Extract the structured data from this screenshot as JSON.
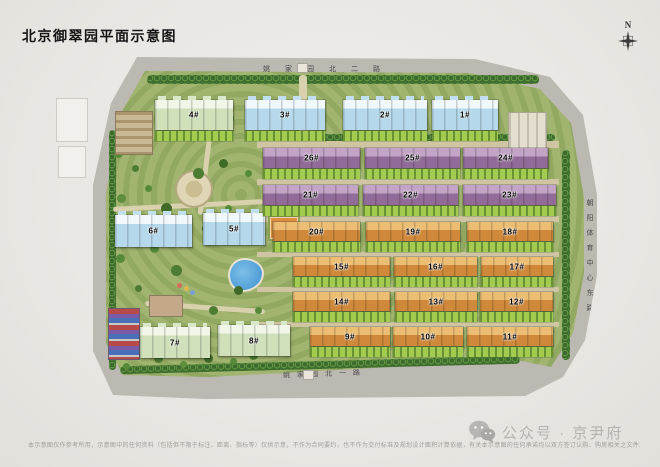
{
  "title": "北京御翠园平面示意图",
  "compass": {
    "north": "N"
  },
  "roads": {
    "top": "姚家园北二路",
    "bottom": "姚家园北一路",
    "right": "朝阳体育中心东路"
  },
  "map": {
    "buildings": [
      {
        "label": "4#",
        "x": 70,
        "y": 45,
        "w": 78,
        "h": 30,
        "palette": "green",
        "garden": true
      },
      {
        "label": "3#",
        "x": 160,
        "y": 45,
        "w": 80,
        "h": 30,
        "palette": "blue",
        "garden": true
      },
      {
        "label": "2#",
        "x": 258,
        "y": 45,
        "w": 84,
        "h": 30,
        "palette": "blue",
        "garden": true
      },
      {
        "label": "1#",
        "x": 347,
        "y": 45,
        "w": 66,
        "h": 30,
        "palette": "blue",
        "garden": true
      },
      {
        "label": "6#",
        "x": 30,
        "y": 160,
        "w": 77,
        "h": 32,
        "palette": "blue",
        "garden": false
      },
      {
        "label": "5#",
        "x": 118,
        "y": 158,
        "w": 62,
        "h": 32,
        "palette": "blue",
        "garden": false
      },
      {
        "label": "7#",
        "x": 55,
        "y": 272,
        "w": 70,
        "h": 31,
        "palette": "green",
        "garden": false
      },
      {
        "label": "8#",
        "x": 133,
        "y": 270,
        "w": 72,
        "h": 31,
        "palette": "green",
        "garden": false
      },
      {
        "label": "26#",
        "x": 178,
        "y": 93,
        "w": 97,
        "h": 20,
        "palette": "purple",
        "garden": true
      },
      {
        "label": "25#",
        "x": 280,
        "y": 93,
        "w": 95,
        "h": 20,
        "palette": "purple",
        "garden": true
      },
      {
        "label": "24#",
        "x": 378,
        "y": 93,
        "w": 85,
        "h": 20,
        "palette": "purple",
        "garden": true
      },
      {
        "label": "21#",
        "x": 178,
        "y": 130,
        "w": 95,
        "h": 20,
        "palette": "purple",
        "garden": true
      },
      {
        "label": "22#",
        "x": 278,
        "y": 130,
        "w": 95,
        "h": 20,
        "palette": "purple",
        "garden": true
      },
      {
        "label": "23#",
        "x": 378,
        "y": 130,
        "w": 93,
        "h": 20,
        "palette": "purple",
        "garden": true
      },
      {
        "label": "20#",
        "x": 188,
        "y": 167,
        "w": 87,
        "h": 19,
        "palette": "orange",
        "garden": true
      },
      {
        "label": "19#",
        "x": 281,
        "y": 167,
        "w": 94,
        "h": 19,
        "palette": "orange",
        "garden": true
      },
      {
        "label": "18#",
        "x": 382,
        "y": 167,
        "w": 86,
        "h": 19,
        "palette": "orange",
        "garden": true
      },
      {
        "label": "15#",
        "x": 208,
        "y": 202,
        "w": 97,
        "h": 19,
        "palette": "orange",
        "garden": true
      },
      {
        "label": "16#",
        "x": 309,
        "y": 202,
        "w": 83,
        "h": 19,
        "palette": "orange",
        "garden": true
      },
      {
        "label": "17#",
        "x": 396,
        "y": 202,
        "w": 72,
        "h": 19,
        "palette": "orange",
        "garden": true
      },
      {
        "label": "14#",
        "x": 208,
        "y": 237,
        "w": 97,
        "h": 19,
        "palette": "orange",
        "garden": true
      },
      {
        "label": "13#",
        "x": 310,
        "y": 237,
        "w": 82,
        "h": 19,
        "palette": "orange",
        "garden": true
      },
      {
        "label": "12#",
        "x": 395,
        "y": 237,
        "w": 73,
        "h": 19,
        "palette": "orange",
        "garden": true
      },
      {
        "label": "9#",
        "x": 225,
        "y": 272,
        "w": 80,
        "h": 19,
        "palette": "orange",
        "garden": true
      },
      {
        "label": "10#",
        "x": 308,
        "y": 272,
        "w": 70,
        "h": 19,
        "palette": "orange",
        "garden": true
      },
      {
        "label": "11#",
        "x": 382,
        "y": 272,
        "w": 86,
        "h": 19,
        "palette": "orange",
        "garden": true
      }
    ],
    "colors": {
      "blue_building": "#b5d9ea",
      "green_building": "#cfe0bb",
      "purple_building": "#916c98",
      "orange_building": "#d0893b",
      "garden": "#a2cb50",
      "road": "#bcb8b2",
      "site_green": "#9cb168",
      "pool": "#3e8fd0"
    }
  },
  "footer": {
    "disclaimer": "本示意图仅作参考所用，示意图中的任何资料（包括但不限于标注、距离、指标等）仅供示意，不作为合同要约，也不作为交付标准及规划设计面积计算依据，有关本示意图的任何承诺均以双方签订认购、购房相关之文件及政府最终批复的规定为准。",
    "wechat_account": "公众号 · 京尹府"
  }
}
